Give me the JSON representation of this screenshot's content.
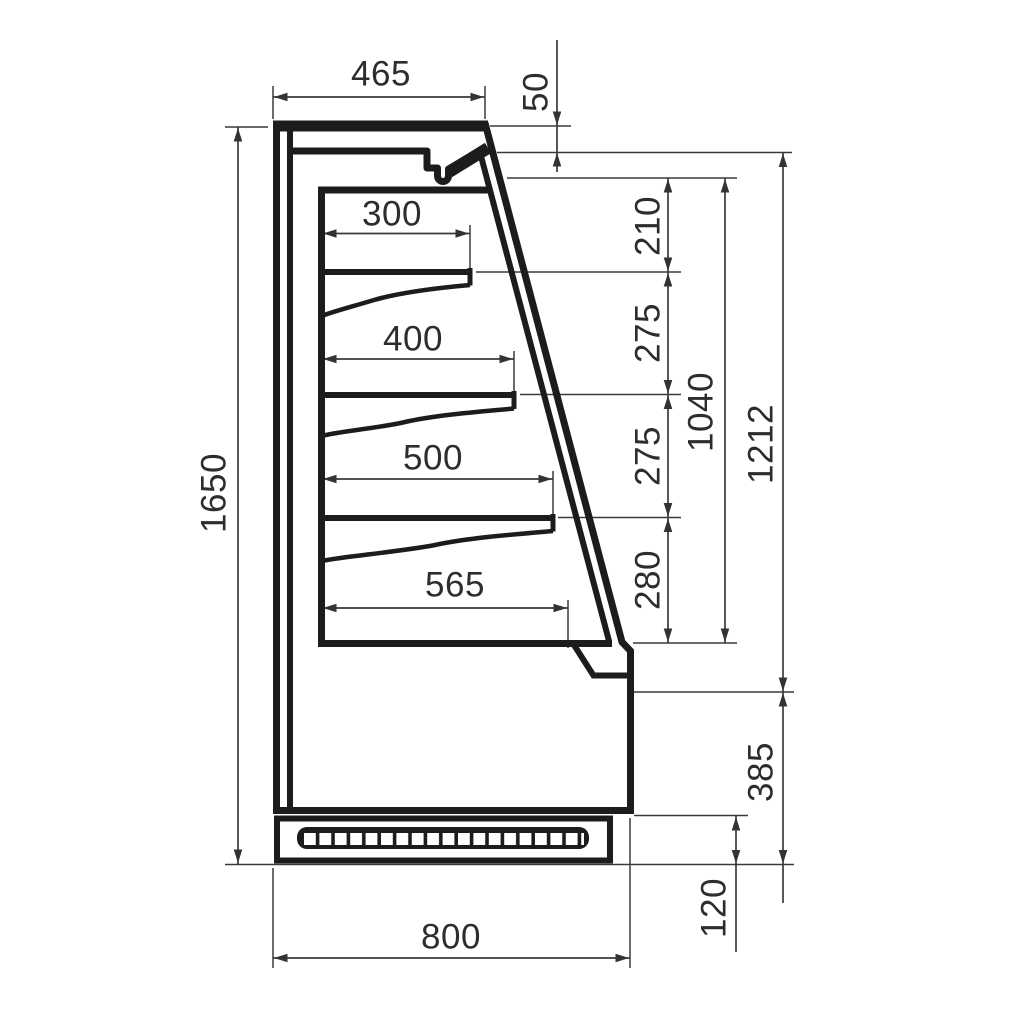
{
  "colors": {
    "background": "#ffffff",
    "outline": "#1c1c1c",
    "dimension_lines": "#3a3a3a",
    "dimension_text": "#2d2d2d"
  },
  "dimensions": {
    "overall_height": "1650",
    "overall_depth": "800",
    "top_depth": "465",
    "canopy_front_height": "50",
    "shelf_depths": [
      "300",
      "400",
      "500",
      "565"
    ],
    "vertical_gaps": [
      "210",
      "275",
      "275",
      "280"
    ],
    "display_opening_height": "1040",
    "front_height": "1212",
    "lower_front_height": "385",
    "plinth_height": "120"
  }
}
